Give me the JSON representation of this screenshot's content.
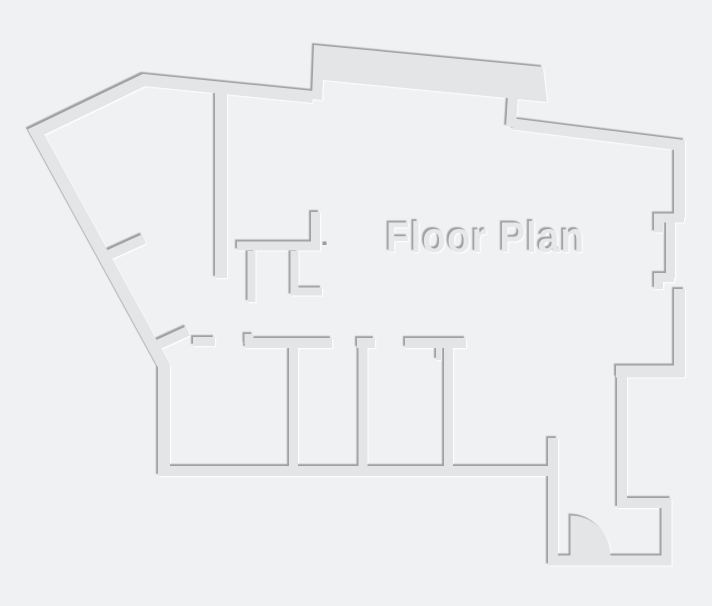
{
  "title": {
    "text": "Floor Plan"
  },
  "canvas": {
    "width": 712,
    "height": 606,
    "background": "#f0f1f2"
  },
  "style": {
    "wall_fill": "#e3e5e6",
    "shadow_dark": "#9fa1a2",
    "shadow_light": "#ffffff",
    "emboss_dark_offset": [
      -1.5,
      -1.5
    ],
    "emboss_light_offset": [
      1.7,
      1.7
    ]
  },
  "floor_plan": {
    "label": {
      "text": "Floor Plan",
      "x": 386,
      "y": 252,
      "font_size": 43,
      "letter_spacing": 1,
      "text_length": 199,
      "fill": "#e6e8e9"
    },
    "walls": [
      {
        "name": "outer-left-and-top",
        "width": 12,
        "points": [
          [
            313,
            97
          ],
          [
            144,
            80
          ],
          [
            36,
            132
          ],
          [
            164,
            366
          ],
          [
            164,
            472
          ]
        ]
      },
      {
        "name": "rooms-bottom-wall",
        "width": 10,
        "points": [
          [
            158,
            471
          ],
          [
            553,
            471
          ]
        ]
      },
      {
        "name": "entry-door-wall",
        "width": 10,
        "points": [
          [
            553,
            438
          ],
          [
            553,
            563
          ]
        ]
      },
      {
        "name": "entry-alcove",
        "width": 10,
        "points": [
          [
            548,
            560.5
          ],
          [
            666.5,
            560.5
          ],
          [
            666.5,
            503
          ],
          [
            622,
            503
          ],
          [
            622,
            377
          ]
        ]
      },
      {
        "name": "entry-step",
        "width": 12,
        "points": [
          [
            616,
            371.5
          ],
          [
            684,
            371.5
          ]
        ]
      },
      {
        "name": "right-wall-lower",
        "width": 11,
        "points": [
          [
            679.5,
            377
          ],
          [
            679.5,
            289
          ]
        ]
      },
      {
        "name": "right-bracket-lower",
        "width": 9,
        "points": [
          [
            674,
            277.5
          ],
          [
            658.5,
            277.5
          ],
          [
            658.5,
            289
          ]
        ]
      },
      {
        "name": "right-wall-mid",
        "width": 9,
        "points": [
          [
            670.5,
            218
          ],
          [
            670.5,
            278
          ]
        ]
      },
      {
        "name": "right-bracket-upper",
        "width": 9,
        "points": [
          [
            684,
            218
          ],
          [
            658.5,
            218
          ],
          [
            658.5,
            232.5
          ]
        ]
      },
      {
        "name": "right-wall-upper",
        "width": 11,
        "points": [
          [
            513,
            124
          ],
          [
            679.5,
            145
          ],
          [
            679.5,
            218
          ]
        ]
      },
      {
        "name": "slab-connector",
        "width": 10,
        "points": [
          [
            513,
            95
          ],
          [
            511,
            127
          ]
        ]
      },
      {
        "name": "hall-wall-vertical",
        "width": 12,
        "points": [
          [
            221,
            88
          ],
          [
            221,
            278
          ]
        ]
      },
      {
        "name": "left-diagonal-stub",
        "width": 10,
        "points": [
          [
            102,
            258
          ],
          [
            144,
            239
          ]
        ]
      },
      {
        "name": "mid-partition",
        "width": 9,
        "points": [
          [
            315.5,
            212
          ],
          [
            315.5,
            246
          ],
          [
            237,
            246
          ]
        ]
      },
      {
        "name": "mid-stub-left",
        "width": 8,
        "points": [
          [
            251.5,
            251
          ],
          [
            251.5,
            302
          ]
        ]
      },
      {
        "name": "mid-l-piece",
        "width": 8,
        "points": [
          [
            294.5,
            251
          ],
          [
            294.5,
            291.5
          ],
          [
            322,
            291.5
          ]
        ]
      },
      {
        "name": "corner-diagonal-stub",
        "width": 10,
        "points": [
          [
            153,
            347
          ],
          [
            188,
            331
          ]
        ]
      },
      {
        "name": "rooms-top-piece-1",
        "width": 9,
        "points": [
          [
            193,
            341.5
          ],
          [
            215,
            341.5
          ]
        ]
      },
      {
        "name": "rooms-top-piece-2",
        "width": 10,
        "points": [
          [
            245,
            343
          ],
          [
            332,
            343
          ]
        ]
      },
      {
        "name": "rooms-top-jog",
        "width": 9,
        "points": [
          [
            249,
            334
          ],
          [
            249,
            344
          ]
        ]
      },
      {
        "name": "room-divider-1",
        "width": 9,
        "points": [
          [
            293.5,
            348
          ],
          [
            293.5,
            467
          ]
        ]
      },
      {
        "name": "rooms-top-piece-3",
        "width": 10,
        "points": [
          [
            357,
            343
          ],
          [
            375,
            343
          ]
        ]
      },
      {
        "name": "room-divider-2",
        "width": 9,
        "points": [
          [
            363,
            348
          ],
          [
            363,
            467
          ]
        ]
      },
      {
        "name": "rooms-top-piece-4",
        "width": 10,
        "points": [
          [
            405,
            343
          ],
          [
            466,
            343
          ]
        ]
      },
      {
        "name": "jamb-stub",
        "width": 5,
        "points": [
          [
            438.5,
            348
          ],
          [
            438.5,
            360
          ]
        ]
      },
      {
        "name": "room-divider-3",
        "width": 9,
        "points": [
          [
            448.5,
            348
          ],
          [
            448.5,
            467
          ]
        ]
      }
    ],
    "polygons": [
      {
        "name": "top-slab",
        "points": [
          [
            314,
            45
          ],
          [
            543,
            67
          ],
          [
            547,
            102
          ],
          [
            323,
            80
          ],
          [
            322,
            100
          ],
          [
            312,
            99
          ]
        ]
      }
    ],
    "door": {
      "name": "entry-door-swing",
      "path": "M 570.5 555.5 L 570.5 515.5 A 40 40 0 0 1 610.5 555.5 Z"
    },
    "dots": [
      {
        "name": "wall-mark-dot",
        "x": 322.5,
        "y": 241.5,
        "w": 4,
        "h": 3.5,
        "fill": "#9b9d9e"
      }
    ]
  }
}
